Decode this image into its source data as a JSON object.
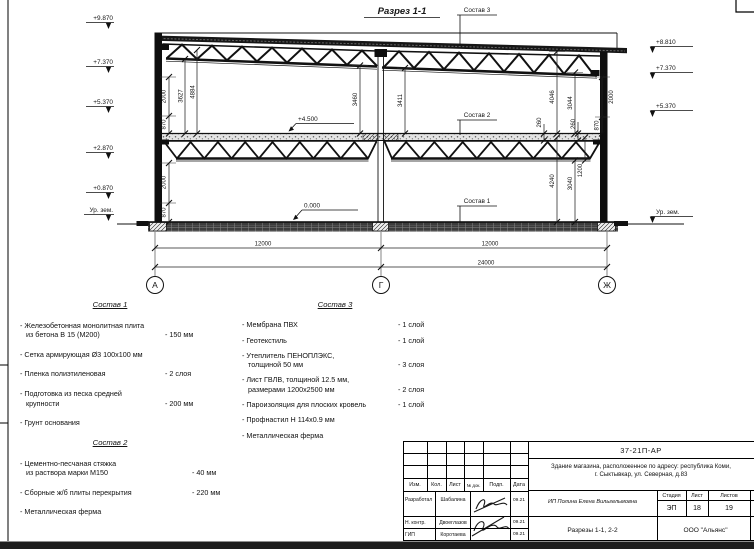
{
  "drawing": {
    "title": "Разрез 1-1",
    "axes": [
      "А",
      "Г",
      "Ж"
    ],
    "marks_left": [
      "+9.870",
      "+7.370",
      "+5.370",
      "+2.870",
      "+0.870",
      "Ур. зем."
    ],
    "marks_right": [
      "+8.810",
      "+7.370",
      "+5.370",
      "Ур. зем."
    ],
    "level_floor": "+4.500",
    "level_zero": "0.000",
    "callouts": [
      "Состав 1",
      "Состав 2",
      "Состав 3"
    ],
    "dims": {
      "span1": "12000",
      "span2": "12000",
      "total": "24000",
      "v": {
        "w2000a": "2000",
        "w870a": "870",
        "h3627": "3627",
        "h4884": "4884",
        "w2000b": "2000",
        "w870b": "870",
        "h3460": "3460",
        "h3411": "3411",
        "h4046": "4046",
        "h3044": "3044",
        "w2000r": "2000",
        "w870r": "870",
        "t260a": "260",
        "t260b": "260",
        "h4240": "4240",
        "h3040": "3040",
        "h1200": "1200"
      }
    }
  },
  "compositions": [
    {
      "title": "Состав 1",
      "items": [
        {
          "l1": "- Железобетонная  монолитная плита",
          "l2": "из бетона В 15 (М200)",
          "val": "- 150 мм"
        },
        {
          "l1": "- Сетка армирующая Ø3 100х100 мм"
        },
        {
          "l1": "- Пленка полиэтиленовая",
          "val": "- 2 слоя"
        },
        {
          "l1": "- Подготовка из песка средней",
          "l2": "крупности",
          "val": "- 200 мм"
        },
        {
          "l1": "- Грунт основания"
        }
      ]
    },
    {
      "title": "Состав 2",
      "items": [
        {
          "l1": "- Цементно-песчаная стяжка",
          "l2": "из раствора марки М150",
          "val": "- 40 мм"
        },
        {
          "l1": "- Сборные ж/б плиты перекрытия",
          "val": "- 220 мм"
        },
        {
          "l1": "- Металлическая ферма"
        }
      ]
    },
    {
      "title": "Состав 3",
      "items": [
        {
          "l1": "- Мембрана ПВХ",
          "val": "- 1 слой"
        },
        {
          "l1": "- Геотекстиль",
          "val": "- 1 слой"
        },
        {
          "l1": "- Утеплитель ПЕНОПЛЭКС,",
          "l2": "толщиной 50 мм",
          "val": "- 3 слоя"
        },
        {
          "l1": "- Лист ГВЛВ, толщиной 12.5 мм,",
          "l2": "размерами 1200х2500 мм",
          "val": "- 2 слоя"
        },
        {
          "l1": "- Пароизоляция для плоских кровель",
          "val": "- 1 слой"
        },
        {
          "l1": "- Профнастил Н 114х0.9 мм"
        },
        {
          "l1": "- Металлическая ферма"
        }
      ]
    }
  ],
  "titleblock": {
    "doc_number": "37-21П-АР",
    "project_line1": "Здание магазина, расположенное по адресу: республика Коми,",
    "project_line2": "г. Сыктывкар, ул. Северная, д.83",
    "client": "ИП Полина Елена Вильгельмовна",
    "sheet_title": "Разрезы 1-1, 2-2",
    "company": "ООО \"Альянс\"",
    "stage_label": "Стадия",
    "sheet_label": "Лист",
    "sheets_label": "Листов",
    "stage": "ЭП",
    "sheet_num": "18",
    "sheets_total": "19",
    "cols": [
      "Изм.",
      "Кол.",
      "Лист",
      "№ док.",
      "Подп.",
      "Дата"
    ],
    "rows": [
      {
        "role": "Разработал",
        "name": "Шабалина",
        "date": "09.21"
      },
      {
        "role": "Н. контр.",
        "name": "Двоеглазов",
        "date": "09.21"
      },
      {
        "role": "ГИП",
        "name": "Коротаева",
        "date": "09.21"
      }
    ]
  }
}
